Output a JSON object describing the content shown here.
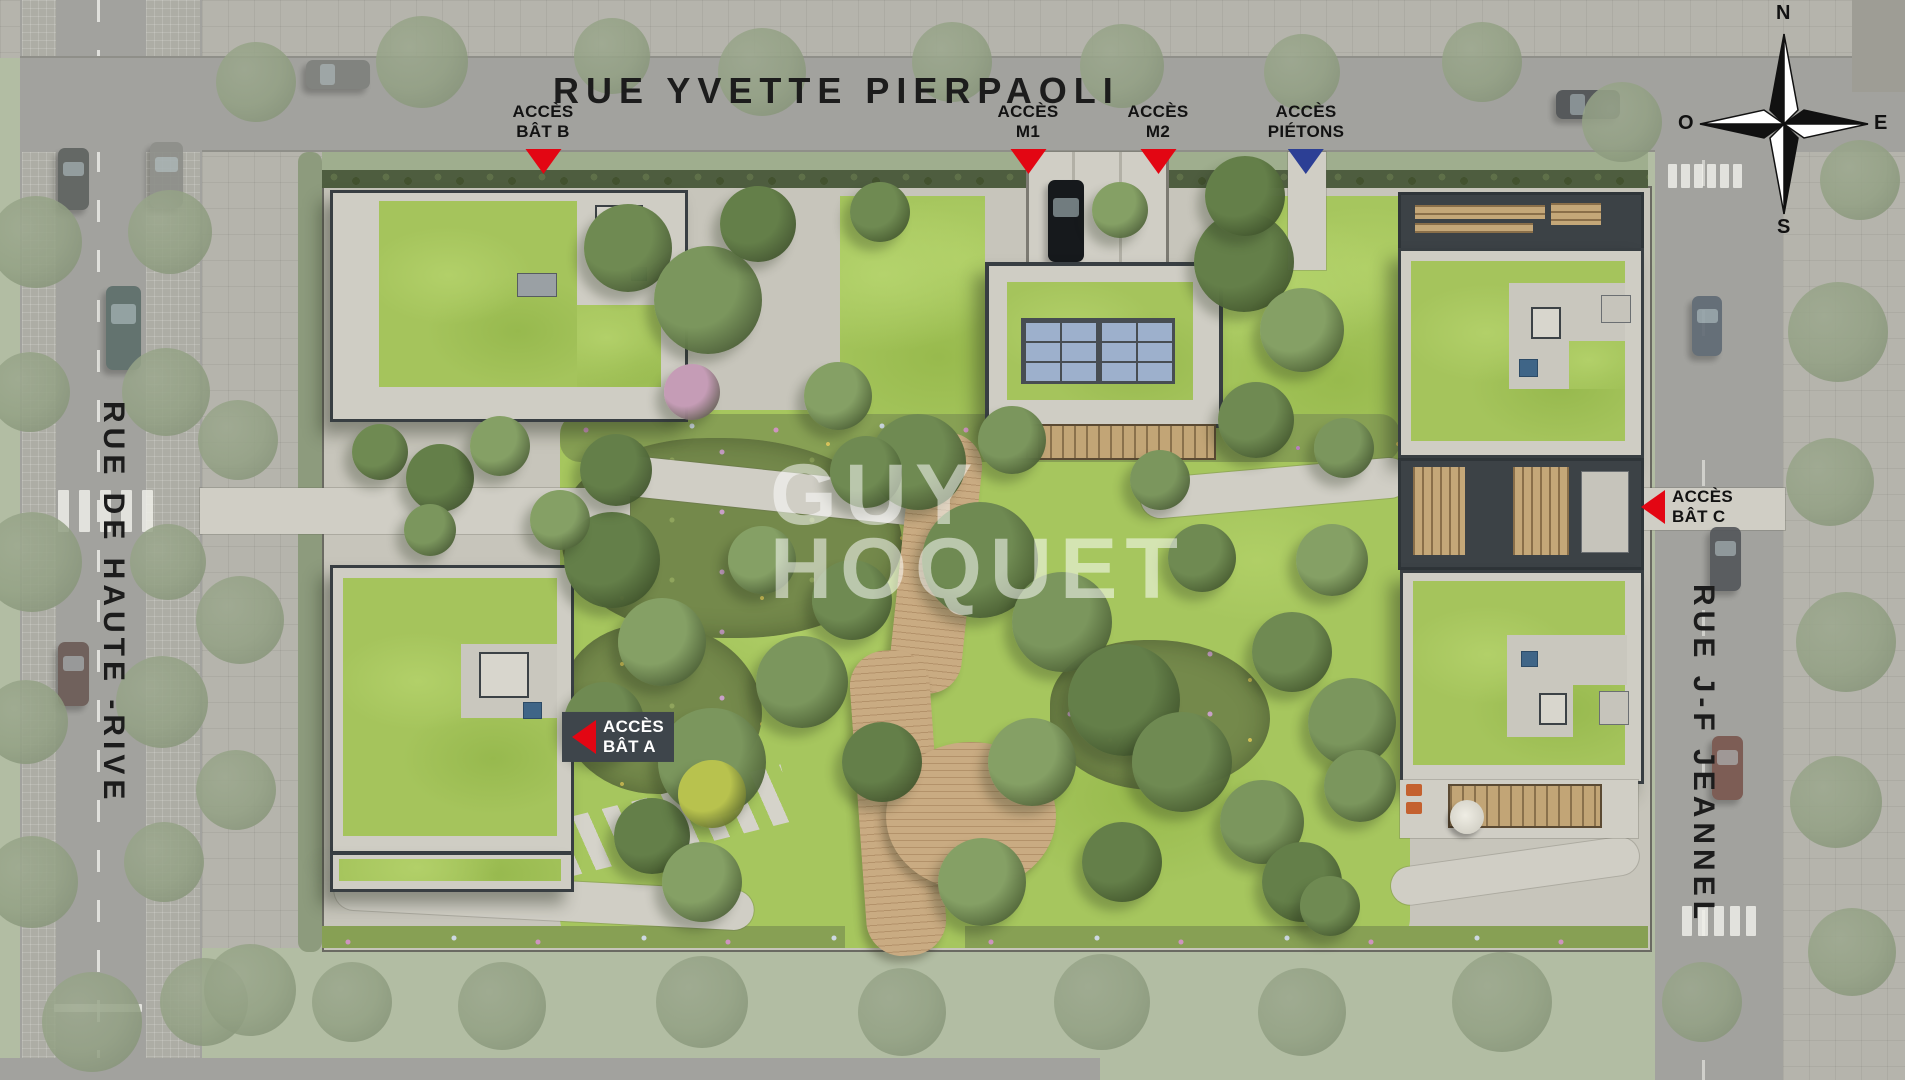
{
  "title": "Plan masse aérien de la résidence",
  "streets": {
    "top": "RUE YVETTE PIERPAOLI",
    "left": "RUE DE HAUTE -RIVE",
    "right": "RUE J-F JEANNEL"
  },
  "watermark": {
    "line1": "GUY",
    "line2": "HOQUET"
  },
  "compass": {
    "n": "N",
    "s": "S",
    "e": "E",
    "w": "O"
  },
  "palette": {
    "marker_red": "#e30613",
    "marker_blue": "#2c3f95",
    "marker_brown": "#b26a41",
    "lawn_green": "#a6c65e",
    "roof_green": "#a5c45c",
    "road_gray": "#a2a29e",
    "concrete": "#cfcdc4",
    "boardwalk_tan": "#c9ab82",
    "solar_blue": "#9db0cc",
    "skylight_blue": "#3f6587"
  },
  "markers": [
    {
      "id": "acces-bat-b",
      "lines": [
        "ACCÈS",
        "BÂT B"
      ],
      "arrow": "down",
      "color": "#e30613",
      "text": "#121212",
      "x": 543,
      "y": 102
    },
    {
      "id": "acces-m1",
      "lines": [
        "ACCÈS",
        "M1"
      ],
      "arrow": "down",
      "color": "#e30613",
      "text": "#121212",
      "x": 1028,
      "y": 102
    },
    {
      "id": "acces-m2",
      "lines": [
        "ACCÈS",
        "M2"
      ],
      "arrow": "down",
      "color": "#e30613",
      "text": "#121212",
      "x": 1158,
      "y": 102
    },
    {
      "id": "acces-pietons-nord",
      "lines": [
        "ACCÈS",
        "PIÉTONS"
      ],
      "arrow": "down",
      "color": "#2c3f95",
      "text": "#121212",
      "x": 1306,
      "y": 102
    },
    {
      "id": "acces-pietons-ouest",
      "lines": [
        "ACCÈS",
        "PIÉTONS"
      ],
      "arrow": "right",
      "color": "#2c3f95",
      "text": "#121212",
      "x": 322,
      "y": 510,
      "side": "end"
    },
    {
      "id": "acces-bat-a",
      "lines": [
        "ACCÈS",
        "BÂT A"
      ],
      "arrow": "left",
      "color": "#e30613",
      "text": "#ffffff",
      "x": 562,
      "y": 737,
      "side": "start",
      "bg": "#3e454b"
    },
    {
      "id": "acces-voitures-parking",
      "lines": [
        "ACCÈS",
        "VOITURES PARKING"
      ],
      "arrow": "right",
      "color": "#b26a41",
      "text": "#121212",
      "x": 322,
      "y": 818,
      "side": "end"
    },
    {
      "id": "acces-pietons-sud",
      "lines": [
        "ACCÈS",
        "PIETONS"
      ],
      "arrow": "right",
      "color": "#2c3f95",
      "text": "#121212",
      "x": 322,
      "y": 906,
      "side": "end"
    },
    {
      "id": "acces-bat-c",
      "lines": [
        "ACCÈS",
        "BÂT C"
      ],
      "arrow": "left",
      "color": "#e30613",
      "text": "#121212",
      "x": 1641,
      "y": 507,
      "side": "start"
    }
  ],
  "scene": {
    "trees_vivid": [
      [
        628,
        248,
        44,
        "#6f8a52"
      ],
      [
        708,
        300,
        54,
        "#7b965d"
      ],
      [
        758,
        224,
        38,
        "#647f49"
      ],
      [
        838,
        396,
        34,
        "#85a065"
      ],
      [
        918,
        462,
        48,
        "#6f8a52"
      ],
      [
        1012,
        440,
        34,
        "#7b965d"
      ],
      [
        1244,
        262,
        50,
        "#647f49"
      ],
      [
        1302,
        330,
        42,
        "#85a065"
      ],
      [
        1256,
        420,
        38,
        "#6f8a52"
      ],
      [
        1344,
        448,
        30,
        "#7b965d"
      ],
      [
        612,
        560,
        48,
        "#647f49"
      ],
      [
        662,
        642,
        44,
        "#85a065"
      ],
      [
        604,
        722,
        40,
        "#6f8a52"
      ],
      [
        712,
        762,
        54,
        "#7b965d"
      ],
      [
        652,
        836,
        38,
        "#647f49"
      ],
      [
        762,
        560,
        34,
        "#85a065"
      ],
      [
        980,
        560,
        58,
        "#6f8a52"
      ],
      [
        1062,
        622,
        50,
        "#7b965d"
      ],
      [
        1124,
        700,
        56,
        "#647f49"
      ],
      [
        1032,
        762,
        44,
        "#85a065"
      ],
      [
        1182,
        762,
        50,
        "#6f8a52"
      ],
      [
        1262,
        822,
        42,
        "#7b965d"
      ],
      [
        1122,
        862,
        40,
        "#647f49"
      ],
      [
        982,
        882,
        44,
        "#85a065"
      ],
      [
        852,
        600,
        40,
        "#6f8a52"
      ],
      [
        802,
        682,
        46,
        "#7b965d"
      ],
      [
        882,
        762,
        40,
        "#647f49"
      ],
      [
        1332,
        560,
        36,
        "#85a065"
      ],
      [
        1292,
        652,
        40,
        "#6f8a52"
      ],
      [
        1352,
        722,
        44,
        "#7b965d"
      ],
      [
        1302,
        882,
        40,
        "#647f49"
      ],
      [
        702,
        882,
        40,
        "#85a065"
      ],
      [
        1202,
        558,
        34,
        "#6f8a52"
      ],
      [
        1160,
        480,
        30,
        "#7b965d"
      ],
      [
        616,
        470,
        36,
        "#647f49"
      ],
      [
        560,
        520,
        30,
        "#85a065"
      ],
      [
        866,
        472,
        36,
        "#6f8a52"
      ],
      [
        1360,
        786,
        36,
        "#7b965d"
      ],
      [
        440,
        478,
        34,
        "#647f49"
      ],
      [
        500,
        446,
        30,
        "#85a065"
      ],
      [
        380,
        452,
        28,
        "#6f8a52"
      ],
      [
        430,
        530,
        26,
        "#7b965d"
      ],
      [
        1245,
        196,
        40,
        "#647f49"
      ],
      [
        1120,
        210,
        28,
        "#85a065"
      ],
      [
        880,
        212,
        30,
        "#6f8a52"
      ],
      [
        692,
        392,
        28,
        "#c59cb6"
      ],
      [
        712,
        794,
        34,
        "#b8c24e"
      ],
      [
        1330,
        906,
        30,
        "#6f8a52"
      ]
    ],
    "trees_faded": [
      [
        36,
        242,
        46
      ],
      [
        30,
        392,
        40
      ],
      [
        32,
        562,
        50
      ],
      [
        26,
        722,
        42
      ],
      [
        32,
        882,
        46
      ],
      [
        170,
        232,
        42
      ],
      [
        166,
        392,
        44
      ],
      [
        168,
        562,
        38
      ],
      [
        162,
        702,
        46
      ],
      [
        164,
        862,
        40
      ],
      [
        92,
        1022,
        50
      ],
      [
        204,
        1002,
        44
      ],
      [
        256,
        82,
        40
      ],
      [
        422,
        62,
        46
      ],
      [
        612,
        56,
        38
      ],
      [
        762,
        72,
        44
      ],
      [
        952,
        62,
        40
      ],
      [
        1122,
        66,
        42
      ],
      [
        1302,
        72,
        38
      ],
      [
        1482,
        62,
        40
      ],
      [
        1622,
        122,
        40
      ],
      [
        250,
        990,
        46
      ],
      [
        352,
        1002,
        40
      ],
      [
        502,
        1006,
        44
      ],
      [
        702,
        1002,
        46
      ],
      [
        902,
        1012,
        44
      ],
      [
        1102,
        1002,
        48
      ],
      [
        1302,
        1012,
        44
      ],
      [
        1502,
        1002,
        50
      ],
      [
        1702,
        1002,
        40
      ],
      [
        1838,
        332,
        50
      ],
      [
        1830,
        482,
        44
      ],
      [
        1846,
        642,
        50
      ],
      [
        1836,
        802,
        46
      ],
      [
        1852,
        952,
        44
      ],
      [
        1860,
        180,
        40
      ],
      [
        238,
        440,
        40
      ],
      [
        240,
        620,
        44
      ],
      [
        236,
        790,
        40
      ]
    ],
    "cars": [
      [
        58,
        148,
        31,
        62,
        "#5e625f"
      ],
      [
        150,
        142,
        33,
        66,
        "#8d8f8a"
      ],
      [
        106,
        286,
        35,
        84,
        "#5d6e6b"
      ],
      [
        58,
        642,
        31,
        64,
        "#6b5a55"
      ],
      [
        1710,
        527,
        31,
        64,
        "#53565a"
      ],
      [
        1692,
        296,
        30,
        60,
        "#5f6a74"
      ],
      [
        1712,
        736,
        31,
        64,
        "#7a564e"
      ],
      [
        306,
        60,
        64,
        29,
        "#7e807c"
      ],
      [
        1556,
        90,
        64,
        29,
        "#4e5254"
      ]
    ],
    "crosswalks": [
      {
        "x": 58,
        "y": 490,
        "n": 5,
        "w": 11,
        "h": 42,
        "gap": 10
      },
      {
        "x": 1668,
        "y": 164,
        "n": 6,
        "w": 9,
        "h": 24,
        "gap": 4
      },
      {
        "x": 1682,
        "y": 906,
        "n": 5,
        "w": 10,
        "h": 30,
        "gap": 6
      }
    ]
  }
}
